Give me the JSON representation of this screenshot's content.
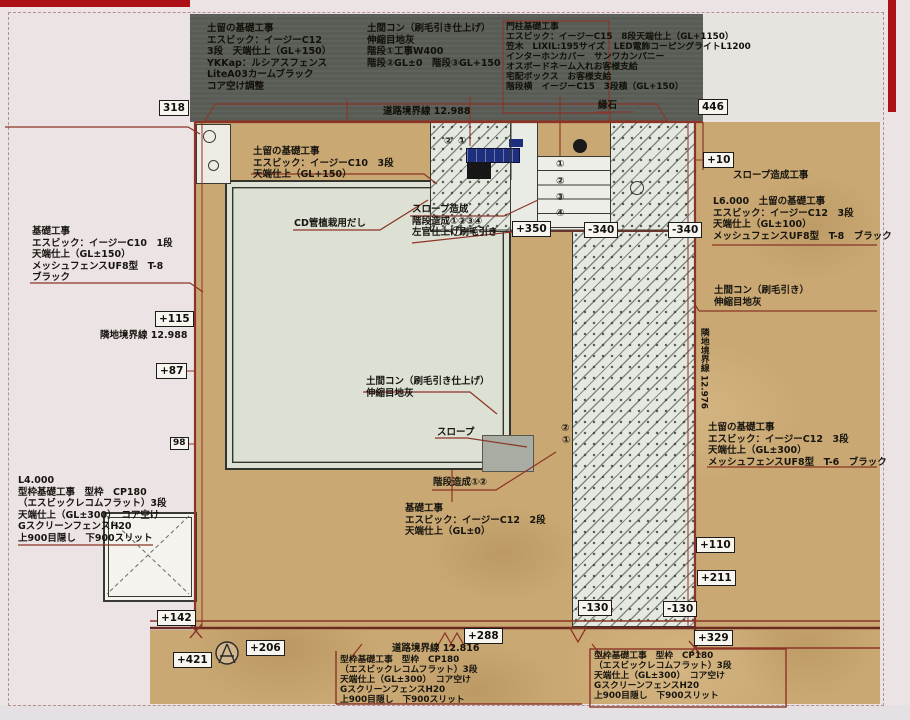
{
  "colors": {
    "accent_red": "#8b3427",
    "road_dark": "#585c55",
    "soil_tan": "#c9a873",
    "concrete": "#dde1d4",
    "post_blue": "#1d2f7d"
  },
  "notes": {
    "road_top_left": {
      "lines": [
        "土留の基礎工事",
        "エスビック：イージーC12",
        "3段　天端仕上（GL+150）",
        "YKKap：ルシアスフェンス",
        "LiteA03カームブラック",
        "コア空け調整"
      ]
    },
    "road_top_mid": {
      "lines": [
        "土間コン（刷毛引き仕上げ）",
        "伸縮目地灰",
        "階段①工事W400",
        "階段②GL±0　階段③GL+150"
      ]
    },
    "road_top_right": {
      "lines": [
        "門柱基礎工事",
        "エスビック：イージーC15　8段天端仕上（GL+1150）",
        "笠木　LIXIL:195サイズ　LED電飾コーピングライトL1200",
        "インターホンカバー　サンワカンパニー",
        "オスボードネーム入れお客様支給",
        "宅配ボックス　お客様支給",
        "階段横　イージーC15　3段積（GL+150）"
      ]
    },
    "curb_label": "縁石",
    "road_boundary_top": "道路境界線 12.988",
    "pad_note": {
      "lines": [
        "土留の基礎工事",
        "エスビック：イージーC10　3段",
        "天端仕上（GL+150）"
      ]
    },
    "cd_pipe": "CD管植栽用だし",
    "slope_note": {
      "lines": [
        "スロープ造成",
        "階段造成①②③④",
        "左官仕上げ刷毛引き"
      ]
    },
    "left_fence": {
      "lines": [
        "基礎工事",
        "エスビック：イージーC10　1段",
        "天端仕上（GL±150）",
        "メッシュフェンスUF8型　T-8",
        "ブラック"
      ]
    },
    "adj_boundary_left": "隣地境界線 12.988",
    "left_form": {
      "lines": [
        "L4.000",
        "型枠基礎工事　型枠　CP180",
        "（エスビックレコムフラット）3段",
        "天端仕上（GL±300）　コア空け",
        "GスクリーンフェンスH20",
        "上900目隠し　下900スリット"
      ]
    },
    "center_slab": {
      "lines": [
        "土間コン（刷毛引き仕上げ）",
        "伸縮目地灰"
      ]
    },
    "slope_label": "スロープ",
    "step_label": "階段造成①②",
    "center_base": {
      "lines": [
        "基礎工事",
        "エスビック：イージーC12　2段",
        "天端仕上（GL±0）"
      ]
    },
    "right_slope": "スロープ造成工事",
    "right_upper": {
      "lines": [
        "L6.000　土留の基礎工事",
        "エスビック：イージーC12　3段",
        "天端仕上（GL±100）",
        "メッシュフェンスUF8型　T-8　ブラック"
      ]
    },
    "right_slab": {
      "lines": [
        "土間コン（刷毛引き）",
        "伸縮目地灰"
      ]
    },
    "adj_boundary_right": "隣地境界線 12.976",
    "right_lower": {
      "lines": [
        "土留の基礎工事",
        "エスビック：イージーC12　3段",
        "天端仕上（GL±300）",
        "メッシュフェンスUF8型　T-6　ブラック"
      ]
    },
    "road_boundary_bottom": "道路境界線 12.816",
    "bottom_center": {
      "lines": [
        "型枠基礎工事　型枠　CP180",
        "（エスビックレコムフラット）3段",
        "天端仕上（GL±300）　コア空け",
        "GスクリーンフェンスH20",
        "上900目隠し　下900スリット"
      ]
    },
    "bottom_right": {
      "lines": [
        "型枠基礎工事　型枠　CP180",
        "（エスビックレコムフラット）3段",
        "天端仕上（GL±300）　コア空け",
        "GスクリーンフェンスH20",
        "上900目隠し　下900スリット"
      ]
    }
  },
  "dims": [
    "318",
    "446",
    "+10",
    "+115",
    "+87",
    "98",
    "+110",
    "+211",
    "-130",
    "-130",
    "+329",
    "+288",
    "+206",
    "+421",
    "+142",
    "+350",
    "-340",
    "-340"
  ],
  "steps": {
    "top_pair": [
      "②",
      "①"
    ],
    "stair_column": [
      "①",
      "②",
      "③",
      "④"
    ],
    "bottom_pair": [
      "②",
      "①"
    ]
  }
}
